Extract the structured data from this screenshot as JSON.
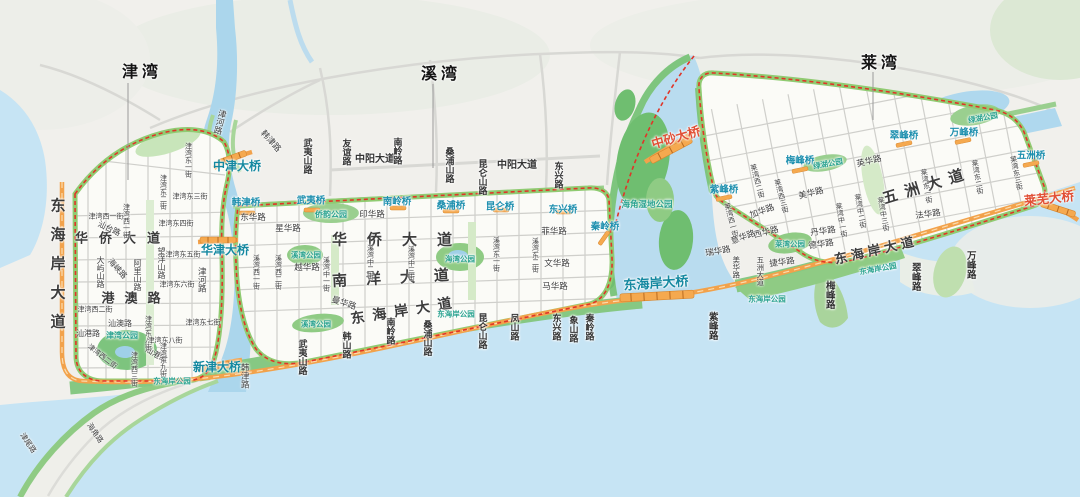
{
  "map": {
    "district_titles": [
      "津湾",
      "溪湾",
      "莱湾"
    ],
    "colors": {
      "water": "#C6E4F4",
      "river": "#ABD6EC",
      "land": "#F1F0EC",
      "park_green": "#7DC47E",
      "band_green": "#90CB72",
      "main_road_orange": "#F2A24B",
      "boundary_red": "#E03528",
      "bridge_label_teal": "#1488A0",
      "park_label_teal": "#2BA390",
      "major_bridge_red": "#E14F35"
    },
    "labels": [
      {
        "id": "title-jinwan",
        "t": "津湾",
        "x": 142,
        "y": 73,
        "s": "T"
      },
      {
        "id": "title-xiwan",
        "t": "溪湾",
        "x": 441,
        "y": 75,
        "s": "T"
      },
      {
        "id": "title-laiwan",
        "t": "莱湾",
        "x": 881,
        "y": 64,
        "s": "T"
      },
      {
        "id": "donghaian-dadao-west",
        "t": "东海岸大道",
        "x": 57,
        "y": 270,
        "s": "B",
        "v": 1,
        "fs": 15,
        "ls": 14
      },
      {
        "id": "huaqiao-dadao-jinwan",
        "t": "华侨大道",
        "x": 123,
        "y": 238,
        "s": "B",
        "fs": 13,
        "ls": 11
      },
      {
        "id": "gangao-lu",
        "t": "港澳路",
        "x": 136,
        "y": 298,
        "s": "B",
        "fs": 13,
        "ls": 10
      },
      {
        "id": "huaqiao-dadao-xiwan",
        "t": "华侨大道",
        "x": 402,
        "y": 240,
        "s": "B",
        "fs": 15,
        "ls": 20
      },
      {
        "id": "nanyang-dadao",
        "t": "南洋大道",
        "x": 400,
        "y": 278,
        "s": "B",
        "fs": 15,
        "ls": 19,
        "r": -3
      },
      {
        "id": "donghaian-dadao-xiwan",
        "t": "东海岸大道",
        "x": 405,
        "y": 310,
        "s": "B",
        "fs": 14,
        "ls": 8,
        "r": -9
      },
      {
        "id": "wuzhou-dadao-big",
        "t": "五洲大道",
        "x": 927,
        "y": 186,
        "s": "B",
        "fs": 15,
        "ls": 8,
        "r": -17
      },
      {
        "id": "donghaian-dadao-laiwan",
        "t": "东海岸大道",
        "x": 876,
        "y": 250,
        "s": "B",
        "fs": 13,
        "ls": 4,
        "r": -13
      },
      {
        "id": "zhongyang-dadao-1",
        "t": "中阳大道",
        "x": 375,
        "y": 160,
        "s": "R",
        "fs": 10
      },
      {
        "id": "zhongyang-dadao-2",
        "t": "中阳大道",
        "x": 517,
        "y": 166,
        "s": "R",
        "fs": 10
      },
      {
        "id": "jinhe-lu-north",
        "t": "津河路",
        "x": 220,
        "y": 122,
        "s": "st",
        "v": 1,
        "fs": 8.5,
        "r": 14
      },
      {
        "id": "hanjin-lu-north",
        "t": "韩津路",
        "x": 271,
        "y": 141,
        "s": "st",
        "fs": 8.5,
        "r": 48
      },
      {
        "id": "zhongjin-daqiao",
        "t": "中津大桥",
        "x": 237,
        "y": 166,
        "s": "BR"
      },
      {
        "id": "wuyishan-lu-nw",
        "t": "武夷山路",
        "x": 307,
        "y": 156,
        "s": "R",
        "v": 1
      },
      {
        "id": "dayushan-lu",
        "t": "大屿山路",
        "x": 100,
        "y": 272,
        "s": "st",
        "v": 1
      },
      {
        "id": "haixia-lu",
        "t": "海峡路",
        "x": 117,
        "y": 269,
        "s": "st",
        "r": 48
      },
      {
        "id": "alishan-lu",
        "t": "阿里山路",
        "x": 137,
        "y": 275,
        "s": "st",
        "v": 1
      },
      {
        "id": "wangyangshan-lu",
        "t": "望洋山路",
        "x": 161,
        "y": 263,
        "s": "st",
        "v": 1
      },
      {
        "id": "shantai-lu",
        "t": "汕台路",
        "x": 109,
        "y": 229,
        "s": "st",
        "r": 25
      },
      {
        "id": "jinwan-xi1-h",
        "t": "津湾西一街",
        "x": 106,
        "y": 217,
        "s": "st",
        "fs": 7
      },
      {
        "id": "jinwan-xi1-v",
        "t": "津湾西一街",
        "x": 126,
        "y": 221,
        "s": "st",
        "v": 1,
        "fs": 7
      },
      {
        "id": "jinwan-xi2-h",
        "t": "津湾西二街",
        "x": 95,
        "y": 310,
        "s": "st",
        "fs": 7
      },
      {
        "id": "jinwan-xi2-d",
        "t": "津湾西二街",
        "x": 102,
        "y": 357,
        "s": "st",
        "fs": 7,
        "r": 38
      },
      {
        "id": "jinwan-xi3-v",
        "t": "津湾西三街",
        "x": 134,
        "y": 369,
        "s": "st",
        "v": 1,
        "fs": 7
      },
      {
        "id": "shanao-lu",
        "t": "汕澳路",
        "x": 120,
        "y": 324,
        "s": "st"
      },
      {
        "id": "shangang-lu-1",
        "t": "汕港路",
        "x": 88,
        "y": 334,
        "s": "st"
      },
      {
        "id": "shangang-lu-2",
        "t": "汕港路",
        "x": 156,
        "y": 355,
        "s": "st",
        "r": 30
      },
      {
        "id": "jinwan-gongyuan",
        "t": "津湾公园",
        "x": 122,
        "y": 336,
        "s": "pk"
      },
      {
        "id": "jinwan-dong1",
        "t": "津湾东一街",
        "x": 188,
        "y": 160,
        "s": "st",
        "v": 1,
        "fs": 7
      },
      {
        "id": "jinwan-dong2",
        "t": "津湾东二街",
        "x": 163,
        "y": 192,
        "s": "st",
        "v": 1,
        "fs": 7
      },
      {
        "id": "jinwan-dong3",
        "t": "津湾东三街",
        "x": 190,
        "y": 197,
        "s": "st",
        "fs": 7
      },
      {
        "id": "jinwan-dong4",
        "t": "津湾东四街",
        "x": 176,
        "y": 224,
        "s": "st",
        "fs": 7
      },
      {
        "id": "jinwan-dong5",
        "t": "津湾东五街",
        "x": 183,
        "y": 255,
        "s": "st",
        "fs": 7
      },
      {
        "id": "jinwan-dong6",
        "t": "津湾东六街",
        "x": 177,
        "y": 285,
        "s": "st",
        "fs": 7
      },
      {
        "id": "jinwan-dong7",
        "t": "津湾东七街",
        "x": 203,
        "y": 323,
        "s": "st",
        "fs": 7
      },
      {
        "id": "jinwan-dong8-v",
        "t": "津湾东八街",
        "x": 148,
        "y": 333,
        "s": "st",
        "v": 1,
        "fs": 7
      },
      {
        "id": "jinwan-dong8-h",
        "t": "津湾东八街",
        "x": 165,
        "y": 341,
        "s": "st",
        "fs": 7
      },
      {
        "id": "jinwan-dong9",
        "t": "津湾东九街",
        "x": 163,
        "y": 360,
        "s": "st",
        "v": 1,
        "fs": 7
      },
      {
        "id": "donghaian-gongyuan-jinwan",
        "t": "东海岸公园",
        "x": 172,
        "y": 381,
        "s": "pk",
        "fs": 7.5
      },
      {
        "id": "xinjin-daqiao",
        "t": "新津大桥",
        "x": 217,
        "y": 367,
        "s": "BR"
      },
      {
        "id": "hanjin-lu-south",
        "t": "韩津路",
        "x": 245,
        "y": 376,
        "s": "st",
        "v": 1,
        "fs": 8.5
      },
      {
        "id": "jinhe-lu-south",
        "t": "津河路",
        "x": 202,
        "y": 280,
        "s": "st",
        "v": 1,
        "fs": 8.5
      },
      {
        "id": "jinwei-lu",
        "t": "津尾路",
        "x": 28,
        "y": 443,
        "s": "st",
        "fs": 7.5,
        "r": 55
      },
      {
        "id": "haijiao-lu",
        "t": "海角路",
        "x": 95,
        "y": 433,
        "s": "st",
        "fs": 7.5,
        "r": 55
      },
      {
        "id": "huajin-daqiao",
        "t": "华津大桥",
        "x": 225,
        "y": 250,
        "s": "BR"
      },
      {
        "id": "youyi-lu",
        "t": "友谊路",
        "x": 346,
        "y": 152,
        "s": "R",
        "v": 1
      },
      {
        "id": "nanling-lu-north",
        "t": "南岭路",
        "x": 397,
        "y": 151,
        "s": "R",
        "v": 1
      },
      {
        "id": "sangpushan-lu-north",
        "t": "桑浦山路",
        "x": 449,
        "y": 165,
        "s": "R",
        "v": 1
      },
      {
        "id": "kunlunshan-lu-north",
        "t": "昆仑山路",
        "x": 482,
        "y": 177,
        "s": "R",
        "v": 1
      },
      {
        "id": "dongxing-lu-north",
        "t": "东兴路",
        "x": 558,
        "y": 175,
        "s": "R",
        "v": 1
      },
      {
        "id": "hanjin-qiao",
        "t": "韩津桥",
        "x": 246,
        "y": 203,
        "s": "br"
      },
      {
        "id": "wuyi-qiao",
        "t": "武夷桥",
        "x": 311,
        "y": 201,
        "s": "br"
      },
      {
        "id": "nanling-qiao",
        "t": "南岭桥",
        "x": 397,
        "y": 202,
        "s": "br"
      },
      {
        "id": "sangpu-qiao",
        "t": "桑浦桥",
        "x": 451,
        "y": 206,
        "s": "br"
      },
      {
        "id": "kunlun-qiao",
        "t": "昆仑桥",
        "x": 500,
        "y": 207,
        "s": "br"
      },
      {
        "id": "dongxing-qiao",
        "t": "东兴桥",
        "x": 563,
        "y": 210,
        "s": "br"
      },
      {
        "id": "qinling-qiao",
        "t": "秦岭桥",
        "x": 605,
        "y": 227,
        "s": "br"
      },
      {
        "id": "qiaoyun-gongyuan",
        "t": "侨韵公园",
        "x": 331,
        "y": 215,
        "s": "pk"
      },
      {
        "id": "donghua-lu",
        "t": "东华路",
        "x": 253,
        "y": 217,
        "s": "st",
        "fs": 8.5
      },
      {
        "id": "yinhua-lu",
        "t": "印华路",
        "x": 372,
        "y": 214,
        "s": "st",
        "fs": 8.5
      },
      {
        "id": "xinghua-lu",
        "t": "星华路",
        "x": 288,
        "y": 228,
        "s": "st",
        "fs": 8.5
      },
      {
        "id": "yuehua-lu",
        "t": "越华路",
        "x": 307,
        "y": 267,
        "s": "st",
        "fs": 8.5
      },
      {
        "id": "xiwan-gongyuan-1",
        "t": "溪湾公园",
        "x": 306,
        "y": 255,
        "s": "pk",
        "fs": 7.5
      },
      {
        "id": "xiwan-gongyuan-2",
        "t": "溪湾公园",
        "x": 316,
        "y": 324,
        "s": "pk",
        "fs": 7.5
      },
      {
        "id": "haiwan-gongyuan",
        "t": "海湾公园",
        "x": 460,
        "y": 259,
        "s": "pk",
        "fs": 7.5
      },
      {
        "id": "donghaian-gongyuan-xiwan",
        "t": "东海岸公园",
        "x": 456,
        "y": 314,
        "s": "pk",
        "fs": 7.5
      },
      {
        "id": "xiwan-xi1",
        "t": "溪湾西一街",
        "x": 256,
        "y": 272,
        "s": "st",
        "v": 1,
        "fs": 7
      },
      {
        "id": "xiwan-xi2",
        "t": "溪湾西二街",
        "x": 278,
        "y": 272,
        "s": "st",
        "v": 1,
        "fs": 7
      },
      {
        "id": "xiwan-zhong1",
        "t": "溪湾中一街",
        "x": 326,
        "y": 274,
        "s": "st",
        "v": 1,
        "fs": 7
      },
      {
        "id": "xiwan-zhong2",
        "t": "溪湾中二街",
        "x": 370,
        "y": 262,
        "s": "st",
        "v": 1,
        "fs": 7
      },
      {
        "id": "xiwan-zhong3",
        "t": "溪湾中三街",
        "x": 411,
        "y": 263,
        "s": "st",
        "v": 1,
        "fs": 7
      },
      {
        "id": "xiwan-dong1",
        "t": "溪湾东一街",
        "x": 496,
        "y": 254,
        "s": "st",
        "v": 1,
        "fs": 7
      },
      {
        "id": "xiwan-dong2",
        "t": "溪湾东二街",
        "x": 535,
        "y": 255,
        "s": "st",
        "v": 1,
        "fs": 7
      },
      {
        "id": "feihua-lu",
        "t": "菲华路",
        "x": 554,
        "y": 231,
        "s": "st",
        "fs": 8.5
      },
      {
        "id": "wenhua-lu",
        "t": "文华路",
        "x": 557,
        "y": 263,
        "s": "st",
        "fs": 8.5
      },
      {
        "id": "mahua-lu",
        "t": "马华路",
        "x": 555,
        "y": 286,
        "s": "st",
        "fs": 8.5
      },
      {
        "id": "manhua-lu",
        "t": "曼华路",
        "x": 344,
        "y": 303,
        "s": "st",
        "fs": 8.5,
        "r": 18
      },
      {
        "id": "wuyishan-lu-south",
        "t": "武夷山路",
        "x": 302,
        "y": 357,
        "s": "R",
        "v": 1
      },
      {
        "id": "hanshan-lu",
        "t": "韩山路",
        "x": 346,
        "y": 345,
        "s": "R",
        "v": 1
      },
      {
        "id": "nanling-lu-south",
        "t": "南岭路",
        "x": 390,
        "y": 331,
        "s": "R",
        "v": 1
      },
      {
        "id": "sangpushan-lu-south",
        "t": "桑浦山路",
        "x": 427,
        "y": 338,
        "s": "R",
        "v": 1
      },
      {
        "id": "kunlunshan-lu-south",
        "t": "昆仑山路",
        "x": 482,
        "y": 331,
        "s": "R",
        "v": 1
      },
      {
        "id": "fengshan-lu",
        "t": "凤山路",
        "x": 514,
        "y": 327,
        "s": "R",
        "v": 1
      },
      {
        "id": "dongxing-lu-south",
        "t": "东兴路",
        "x": 556,
        "y": 327,
        "s": "R",
        "v": 1
      },
      {
        "id": "xiangshan-lu",
        "t": "象山路",
        "x": 573,
        "y": 329,
        "s": "R",
        "v": 1
      },
      {
        "id": "qinling-lu",
        "t": "秦岭路",
        "x": 589,
        "y": 327,
        "s": "R",
        "v": 1
      },
      {
        "id": "donghaian-daqiao",
        "t": "东海岸大桥",
        "x": 656,
        "y": 283,
        "s": "BR",
        "fs": 13,
        "r": -4
      },
      {
        "id": "zhongsha-daqiao",
        "t": "中砂大桥",
        "x": 676,
        "y": 138,
        "s": "rb",
        "r": -16
      },
      {
        "id": "haijiao-shidi-gongyuan",
        "t": "海角湿地公园",
        "x": 647,
        "y": 204,
        "s": "pk",
        "fs": 8.5
      },
      {
        "id": "laiwu-daqiao",
        "t": "莱芜大桥",
        "x": 1049,
        "y": 199,
        "s": "rb",
        "r": -6
      },
      {
        "id": "zifeng-qiao",
        "t": "紫峰桥",
        "x": 724,
        "y": 190,
        "s": "br"
      },
      {
        "id": "meifeng-qiao",
        "t": "梅峰桥",
        "x": 800,
        "y": 161,
        "s": "br"
      },
      {
        "id": "cuifeng-qiao",
        "t": "翠峰桥",
        "x": 904,
        "y": 136,
        "s": "br"
      },
      {
        "id": "wanfeng-qiao",
        "t": "万峰桥",
        "x": 964,
        "y": 133,
        "s": "br"
      },
      {
        "id": "wuzhou-qiao",
        "t": "五洲桥",
        "x": 1031,
        "y": 156,
        "s": "br"
      },
      {
        "id": "lvhu-gongyuan-1",
        "t": "绿湖公园",
        "x": 828,
        "y": 164,
        "s": "pk",
        "fs": 7.5,
        "r": -10
      },
      {
        "id": "lvhu-gongyuan-2",
        "t": "绿湖公园",
        "x": 983,
        "y": 118,
        "s": "pk",
        "fs": 7.5,
        "r": -10
      },
      {
        "id": "laiwan-gongyuan",
        "t": "莱湾公园",
        "x": 790,
        "y": 244,
        "s": "pk",
        "fs": 7.5
      },
      {
        "id": "donghaian-gongyuan-laiwan-1",
        "t": "东海岸公园",
        "x": 767,
        "y": 299,
        "s": "pk",
        "fs": 7.5
      },
      {
        "id": "donghaian-gongyuan-laiwan-2",
        "t": "东海岸公园",
        "x": 878,
        "y": 269,
        "s": "pk",
        "fs": 7.5,
        "r": -10
      },
      {
        "id": "laiwan-xi1",
        "t": "莱湾西一街",
        "x": 731,
        "y": 220,
        "s": "st",
        "v": 1,
        "fs": 7,
        "r": -15
      },
      {
        "id": "laiwan-xi2",
        "t": "莱湾西二街",
        "x": 757,
        "y": 181,
        "s": "st",
        "v": 1,
        "fs": 7,
        "r": -15
      },
      {
        "id": "laiwan-xi3",
        "t": "莱湾西三街",
        "x": 781,
        "y": 196,
        "s": "st",
        "v": 1,
        "fs": 7,
        "r": -15
      },
      {
        "id": "laiwan-zhong1",
        "t": "莱湾中一街",
        "x": 841,
        "y": 220,
        "s": "st",
        "v": 1,
        "fs": 7,
        "r": -10
      },
      {
        "id": "laiwan-zhong2",
        "t": "莱湾中二街",
        "x": 860,
        "y": 211,
        "s": "st",
        "v": 1,
        "fs": 7,
        "r": -10
      },
      {
        "id": "laiwan-zhong3",
        "t": "莱湾中三街",
        "x": 883,
        "y": 214,
        "s": "st",
        "v": 1,
        "fs": 7,
        "r": -10
      },
      {
        "id": "laiwan-dong1",
        "t": "莱湾东一街",
        "x": 926,
        "y": 186,
        "s": "st",
        "v": 1,
        "fs": 7,
        "r": -10
      },
      {
        "id": "laiwan-dong2",
        "t": "莱湾东二街",
        "x": 977,
        "y": 177,
        "s": "st",
        "v": 1,
        "fs": 7,
        "r": -10
      },
      {
        "id": "laiwan-dong3",
        "t": "莱湾东三街",
        "x": 1016,
        "y": 173,
        "s": "st",
        "v": 1,
        "fs": 7,
        "r": -12
      },
      {
        "id": "yinghua-lu",
        "t": "英华路",
        "x": 869,
        "y": 161,
        "s": "st",
        "fs": 8.5,
        "r": -14
      },
      {
        "id": "meihua-lu-1",
        "t": "美华路",
        "x": 811,
        "y": 193,
        "s": "st",
        "fs": 8.5,
        "r": -14
      },
      {
        "id": "jiahua-lu",
        "t": "加华路",
        "x": 762,
        "y": 211,
        "s": "st",
        "fs": 8.5,
        "r": -20
      },
      {
        "id": "xihua-lu",
        "t": "西华路",
        "x": 766,
        "y": 232,
        "s": "st",
        "fs": 8.5,
        "r": -14
      },
      {
        "id": "yihua-lu",
        "t": "意华路",
        "x": 743,
        "y": 237,
        "s": "st",
        "fs": 8.5,
        "r": -20
      },
      {
        "id": "ruihua-lu",
        "t": "瑞华路",
        "x": 718,
        "y": 251,
        "s": "st",
        "fs": 8.5,
        "r": -10
      },
      {
        "id": "meihua-lu-2",
        "t": "美华路",
        "x": 736,
        "y": 267,
        "s": "st",
        "v": 1,
        "fs": 7.5
      },
      {
        "id": "wuzhou-dadao-small",
        "t": "五洲大道",
        "x": 760,
        "y": 271,
        "s": "st",
        "v": 1,
        "fs": 7.5
      },
      {
        "id": "jiehua-lu",
        "t": "捷华路",
        "x": 782,
        "y": 262,
        "s": "st",
        "fs": 8.5,
        "r": -8
      },
      {
        "id": "danhua-lu",
        "t": "丹华路",
        "x": 823,
        "y": 231,
        "s": "st",
        "fs": 8.5,
        "r": -8
      },
      {
        "id": "dehua-lu",
        "t": "德华路",
        "x": 821,
        "y": 244,
        "s": "st",
        "fs": 8.5,
        "r": -8
      },
      {
        "id": "fahua-lu",
        "t": "法华路",
        "x": 928,
        "y": 214,
        "s": "st",
        "fs": 8.5,
        "r": -8
      },
      {
        "id": "zifeng-lu",
        "t": "紫峰路",
        "x": 712,
        "y": 326,
        "s": "R",
        "v": 1,
        "fs": 9.5
      },
      {
        "id": "meifeng-lu",
        "t": "梅峰路",
        "x": 829,
        "y": 295,
        "s": "R",
        "v": 1,
        "fs": 9.5
      },
      {
        "id": "cuifeng-lu",
        "t": "翠峰路",
        "x": 915,
        "y": 277,
        "s": "R",
        "v": 1,
        "fs": 9.5
      },
      {
        "id": "wanfeng-lu",
        "t": "万峰路",
        "x": 970,
        "y": 265,
        "s": "R",
        "v": 1,
        "fs": 9.5
      }
    ]
  }
}
